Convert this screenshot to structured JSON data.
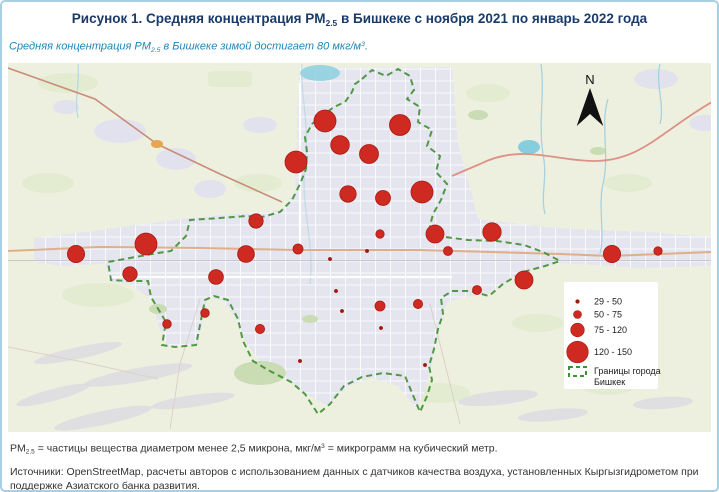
{
  "colors": {
    "bubble": "#cf2a22",
    "bubble_stroke": "#a81a12",
    "bubble_small": "#9c1a12",
    "boundary": "#3f8f33",
    "title": "#1a3a68",
    "subtitle": "#1f86b8"
  },
  "title": {
    "pre": "Рисунок 1. Средняя концентрация PM",
    "sub": "2.5",
    "post": " в Бишкеке с ноября 2021 по январь 2022 года"
  },
  "subtitle": {
    "pre": "Средняя концентрация PM",
    "sub": "2.5",
    "mid": " в Бишкеке зимой достигает 80 мкг/м",
    "sup": "3",
    "post": "."
  },
  "map": {
    "north_label": "N",
    "legend": {
      "sizes": [
        {
          "label": "29 - 50",
          "r": 1.8
        },
        {
          "label": "50 - 75",
          "r": 4
        },
        {
          "label": "75 - 120",
          "r": 6.8
        },
        {
          "label": "120 - 150",
          "r": 10.8
        }
      ],
      "boundary": {
        "line1": "Границы города",
        "line2": "Бишкек"
      }
    }
  },
  "chart_data": {
    "type": "bubble-map",
    "title": "Средняя концентрация PM2.5 в Бишкеке с ноября 2021 по январь 2022 года",
    "units": "мкг/м³",
    "legend_bins": [
      "29 - 50",
      "50 - 75",
      "75 - 120",
      "120 - 150"
    ],
    "boundary_legend": "Границы города Бишкек",
    "points": [
      {
        "x": 317,
        "y": 58,
        "r": 11,
        "category": "120 - 150"
      },
      {
        "x": 332,
        "y": 82,
        "r": 9.3,
        "category": "75 - 120"
      },
      {
        "x": 361,
        "y": 91,
        "r": 9.5,
        "category": "75 - 120"
      },
      {
        "x": 288,
        "y": 99,
        "r": 11,
        "category": "120 - 150"
      },
      {
        "x": 340,
        "y": 131,
        "r": 8.2,
        "category": "75 - 120"
      },
      {
        "x": 392,
        "y": 62,
        "r": 10.5,
        "category": "120 - 150"
      },
      {
        "x": 375,
        "y": 135,
        "r": 7.5,
        "category": "75 - 120"
      },
      {
        "x": 414,
        "y": 129,
        "r": 11,
        "category": "120 - 150"
      },
      {
        "x": 248,
        "y": 158,
        "r": 7.2,
        "category": "75 - 120"
      },
      {
        "x": 138,
        "y": 181,
        "r": 11,
        "category": "120 - 150"
      },
      {
        "x": 68,
        "y": 191,
        "r": 8.6,
        "category": "75 - 120"
      },
      {
        "x": 122,
        "y": 211,
        "r": 7.2,
        "category": "75 - 120"
      },
      {
        "x": 238,
        "y": 191,
        "r": 8.4,
        "category": "75 - 120"
      },
      {
        "x": 208,
        "y": 214,
        "r": 7.4,
        "category": "75 - 120"
      },
      {
        "x": 290,
        "y": 186,
        "r": 5,
        "category": "50 - 75"
      },
      {
        "x": 197,
        "y": 250,
        "r": 4.3,
        "category": "50 - 75"
      },
      {
        "x": 159,
        "y": 261,
        "r": 4.3,
        "category": "50 - 75"
      },
      {
        "x": 252,
        "y": 266,
        "r": 4.6,
        "category": "50 - 75"
      },
      {
        "x": 372,
        "y": 171,
        "r": 4.2,
        "category": "50 - 75"
      },
      {
        "x": 427,
        "y": 171,
        "r": 9,
        "category": "75 - 120"
      },
      {
        "x": 484,
        "y": 169,
        "r": 9.2,
        "category": "75 - 120"
      },
      {
        "x": 440,
        "y": 188,
        "r": 4.5,
        "category": "50 - 75"
      },
      {
        "x": 604,
        "y": 191,
        "r": 8.6,
        "category": "75 - 120"
      },
      {
        "x": 650,
        "y": 188,
        "r": 4.2,
        "category": "50 - 75"
      },
      {
        "x": 516,
        "y": 217,
        "r": 9,
        "category": "75 - 120"
      },
      {
        "x": 469,
        "y": 227,
        "r": 4.5,
        "category": "50 - 75"
      },
      {
        "x": 372,
        "y": 243,
        "r": 5,
        "category": "50 - 75"
      },
      {
        "x": 410,
        "y": 241,
        "r": 4.6,
        "category": "50 - 75"
      },
      {
        "x": 322,
        "y": 196,
        "r": 1.8,
        "category": "29 - 50"
      },
      {
        "x": 328,
        "y": 228,
        "r": 1.8,
        "category": "29 - 50"
      },
      {
        "x": 334,
        "y": 248,
        "r": 1.8,
        "category": "29 - 50"
      },
      {
        "x": 292,
        "y": 298,
        "r": 1.8,
        "category": "29 - 50"
      },
      {
        "x": 359,
        "y": 188,
        "r": 1.8,
        "category": "29 - 50"
      },
      {
        "x": 417,
        "y": 302,
        "r": 1.8,
        "category": "29 - 50"
      },
      {
        "x": 373,
        "y": 265,
        "r": 1.8,
        "category": "29 - 50"
      }
    ]
  },
  "footnote": {
    "pre": "PM",
    "sub": "2.5",
    "mid": " = частицы вещества диаметром менее 2,5 микрона, мкг/м",
    "sup": "3",
    "post": " = микрограмм на кубический метр."
  },
  "sources": "Источники: OpenStreetMap, расчеты авторов с использованием данных с датчиков качества воздуха, установленных Кыргызгидрометом при поддержке Азиатского банка развития."
}
